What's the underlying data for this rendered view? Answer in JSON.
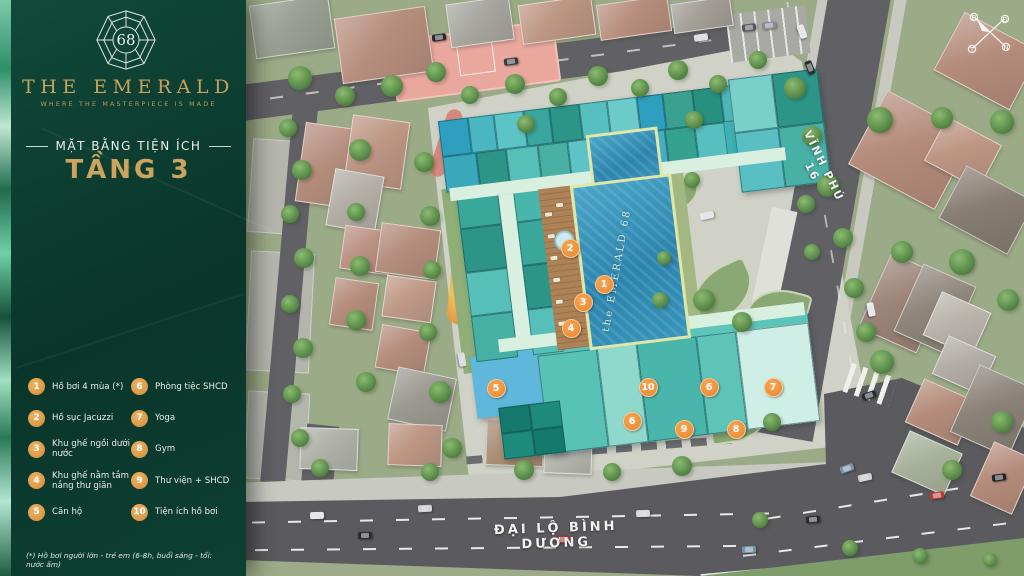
{
  "panel": {
    "logo": {
      "number": "68",
      "name": "THE EMERALD",
      "tagline": "WHERE THE MASTERPIECE IS MADE"
    },
    "subtitle": "MẶT BẰNG TIỆN ÍCH",
    "title": "TẦNG 3",
    "legend": [
      {
        "num": "1",
        "label": "Hồ bơi 4 mùa (*)"
      },
      {
        "num": "2",
        "label": "Hồ sục Jacuzzi"
      },
      {
        "num": "3",
        "label": "Khu ghế ngồi dưới nước"
      },
      {
        "num": "4",
        "label": "Khu ghế nằm tắm nắng thư giãn"
      },
      {
        "num": "5",
        "label": "Căn hộ"
      },
      {
        "num": "6",
        "label": "Phòng tiệc SHCD"
      },
      {
        "num": "7",
        "label": "Yoga"
      },
      {
        "num": "8",
        "label": "Gym"
      },
      {
        "num": "9",
        "label": "Thư viện + SHCD"
      },
      {
        "num": "10",
        "label": "Tiện ích hồ bơi"
      }
    ],
    "footnote": "(*) Hồ bơi người lớn - trẻ em (6-8h, buổi sáng - tối: nước ấm)"
  },
  "map": {
    "streets": {
      "right": "VĨNH PHÚ 16",
      "bottom": "ĐẠI LỘ BÌNH DƯƠNG"
    },
    "pool_label": "the EMERALD 68",
    "compass": {
      "n": "B",
      "e": "Đ",
      "w": "T",
      "s": "N"
    },
    "markers": [
      {
        "num": "1",
        "x": 603,
        "y": 283
      },
      {
        "num": "2",
        "x": 569,
        "y": 247
      },
      {
        "num": "3",
        "x": 582,
        "y": 301
      },
      {
        "num": "4",
        "x": 570,
        "y": 327
      },
      {
        "num": "5",
        "x": 495,
        "y": 387
      },
      {
        "num": "6",
        "x": 708,
        "y": 386
      },
      {
        "num": "6",
        "x": 631,
        "y": 420
      },
      {
        "num": "7",
        "x": 772,
        "y": 386
      },
      {
        "num": "8",
        "x": 735,
        "y": 428
      },
      {
        "num": "9",
        "x": 683,
        "y": 428
      },
      {
        "num": "10",
        "x": 647,
        "y": 386
      }
    ],
    "colors": {
      "panel_green": "#0c4033",
      "gold": "#c9a158",
      "marker_orange": "#ec8e38",
      "pool_blue": "#3795bb",
      "road_gray": "#616165"
    }
  }
}
